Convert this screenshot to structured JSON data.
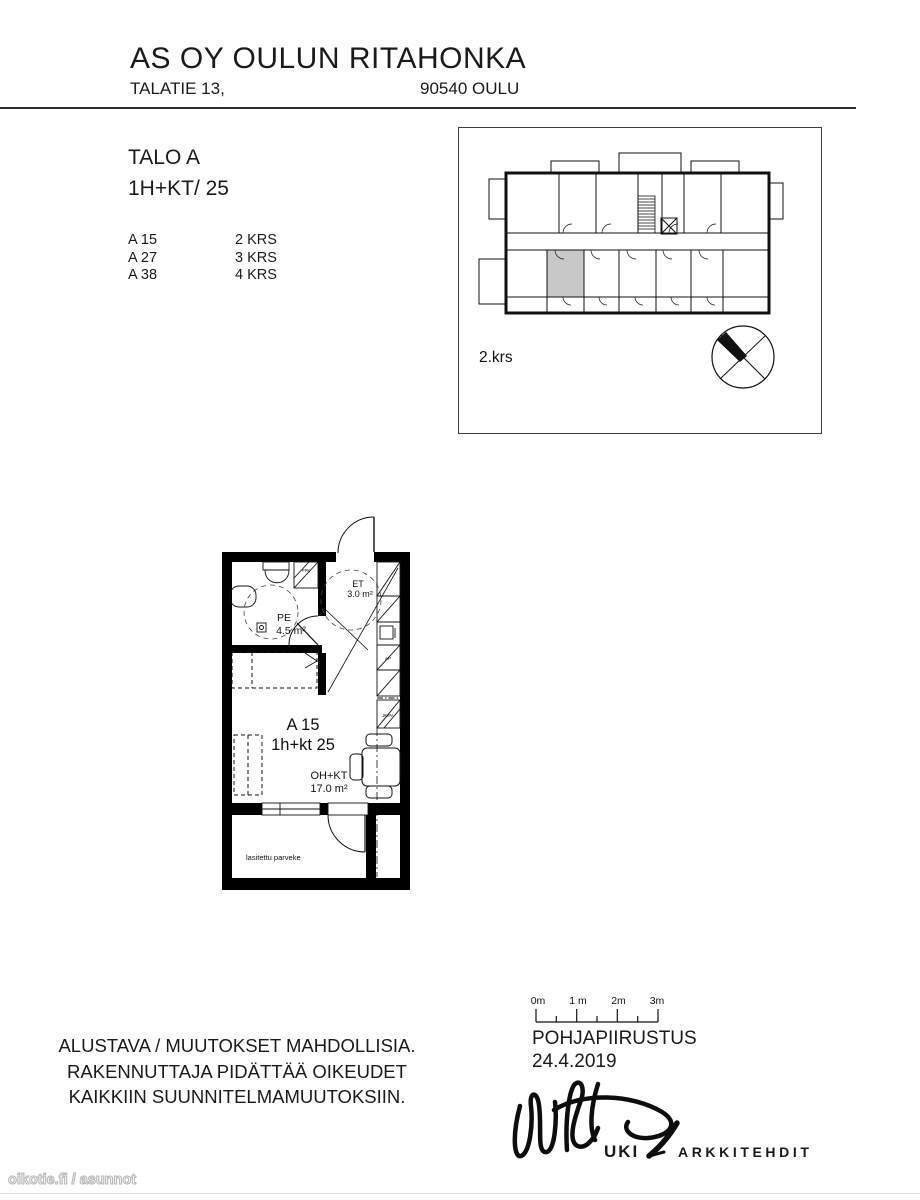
{
  "header": {
    "title": "AS OY OULUN RITAHONKA",
    "street": "TALATIE 13,",
    "postal": "90540 OULU"
  },
  "listing": {
    "building": "TALO A",
    "apartment_type": "1H+KT/ 25",
    "units": [
      {
        "id": "A 15",
        "floor": "2 KRS"
      },
      {
        "id": "A 27",
        "floor": "3 KRS"
      },
      {
        "id": "A 38",
        "floor": "4 KRS"
      }
    ]
  },
  "overview": {
    "floor_label": "2.krs"
  },
  "plan": {
    "unit_id": "A 15",
    "unit_type": "1h+kt 25",
    "rooms": {
      "pe": {
        "code": "PE",
        "area": "4.5 m²"
      },
      "et": {
        "code": "ET",
        "area": "3.0 m²"
      },
      "ohkt": {
        "code": "OH+KT",
        "area": "17.0 m²"
      }
    },
    "balcony_label": "lasitettu parveke",
    "appliances": {
      "ppk": "PPK",
      "ap": "AP",
      "jkpa": "JK/PA"
    }
  },
  "scalebar": {
    "labels": [
      "0m",
      "1 m",
      "2m",
      "3m"
    ]
  },
  "footer": {
    "drawing_type": "POHJAPIIRUSTUS",
    "date": "24.4.2019",
    "disclaimer": [
      "ALUSTAVA / MUUTOKSET MAHDOLLISIA.",
      "RAKENNUTTAJA PIDÄTTÄÄ OIKEUDET",
      "KAIKKIIN SUUNNITELMAMUUTOKSIIN."
    ],
    "architect": {
      "brand": "UKI",
      "brand_suffix": "ARKKITEHDIT"
    }
  },
  "watermark": "oikotie.fi / asunnot",
  "colors": {
    "highlight": "#c8c8c8",
    "line": "#111111",
    "text": "#1a1a1a"
  }
}
